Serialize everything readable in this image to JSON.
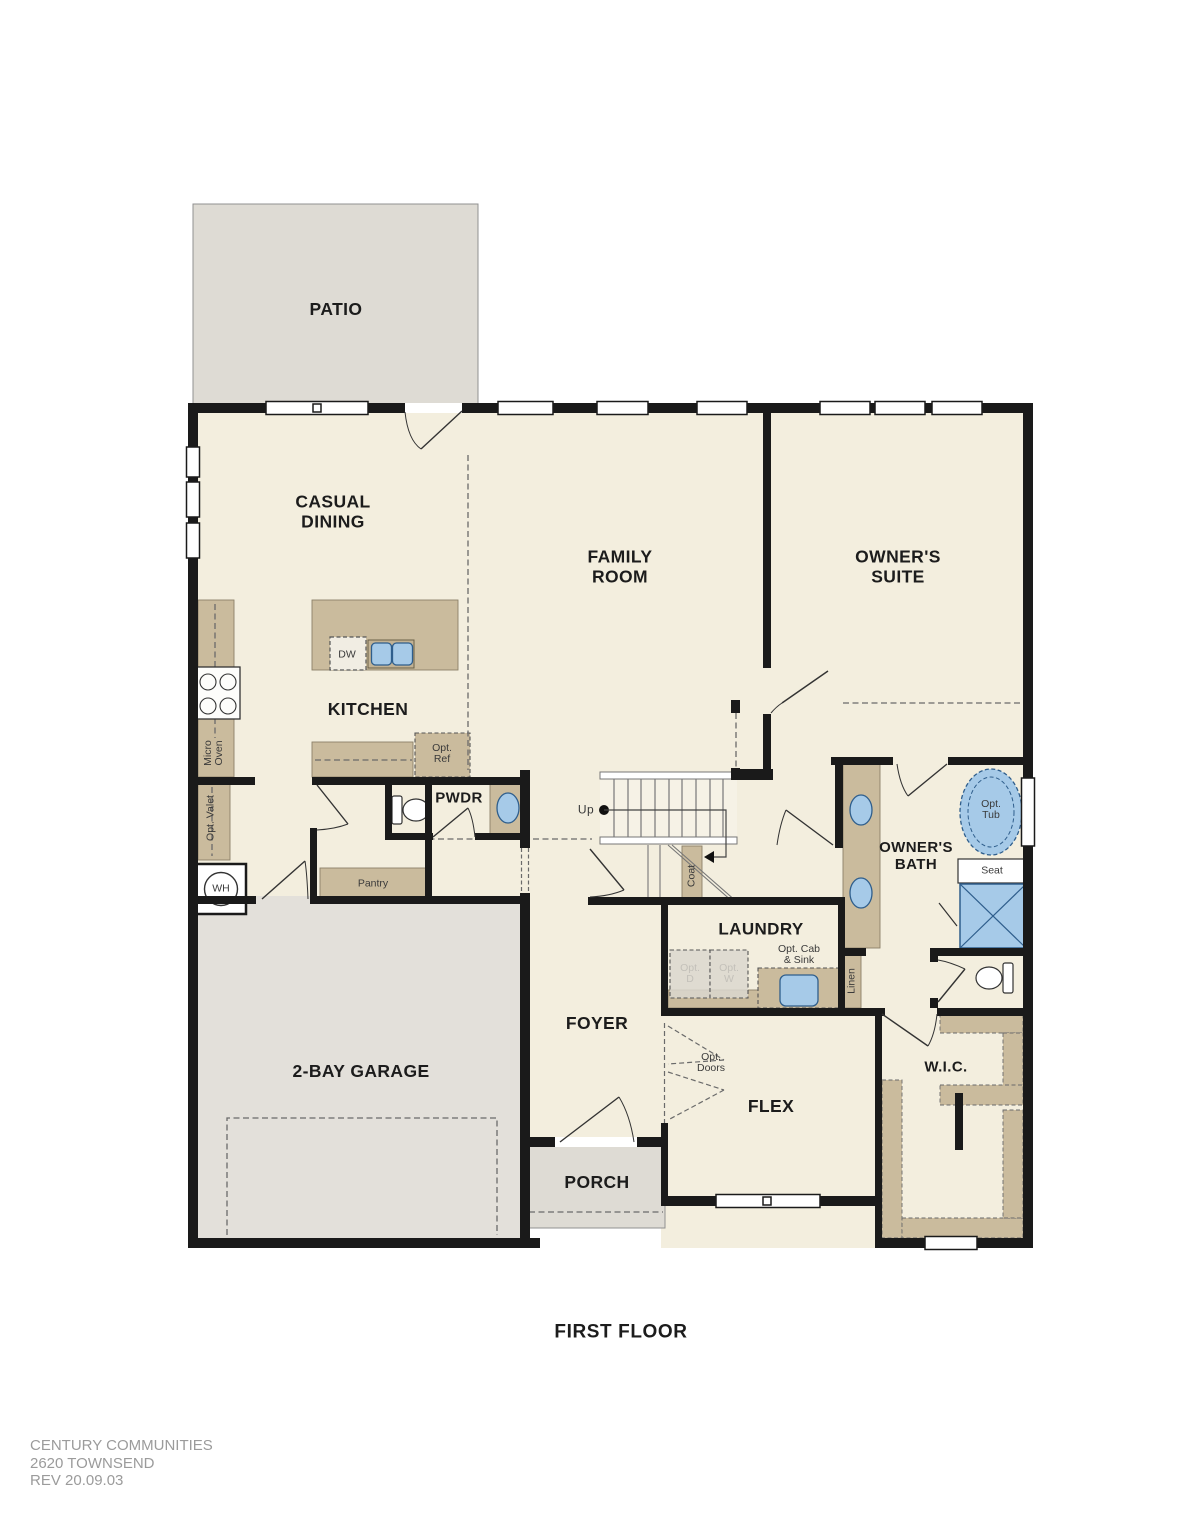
{
  "title": "FIRST FLOOR",
  "footer": {
    "company": "CENTURY COMMUNITIES",
    "plan_name": "2620 TOWNSEND",
    "revision": "REV 20.09.03"
  },
  "rooms": {
    "patio": "PATIO",
    "casual_dining": "CASUAL\nDINING",
    "family_room": "FAMILY\nROOM",
    "owners_suite": "OWNER'S\nSUITE",
    "kitchen": "KITCHEN",
    "pwdr": "PWDR",
    "garage": "2-BAY GARAGE",
    "foyer": "FOYER",
    "laundry": "LAUNDRY",
    "owners_bath": "OWNER'S\nBATH",
    "flex": "FLEX",
    "porch": "PORCH",
    "wic": "W.I.C."
  },
  "features": {
    "micro_oven": "Micro\nOven",
    "opt_valet": "Opt. Valet",
    "water_heater": "WH",
    "pantry": "Pantry",
    "dishwasher": "DW",
    "opt_ref": "Opt.\nRef",
    "up": "Up",
    "coat": "Coat",
    "opt_dryer": "Opt.\nD",
    "opt_washer": "Opt.\nW",
    "opt_cab_sink": "Opt. Cab\n& Sink",
    "linen": "Linen",
    "opt_tub": "Opt.\nTub",
    "seat": "Seat",
    "opt_doors": "Opt.\nDoors"
  },
  "colors": {
    "wall": "#1a1a1a",
    "room_fill": "#f3eede",
    "patio_porch_fill": "#dedbd4",
    "garage_fill": "#e3e0da",
    "cabinet_tan": "#cabb9d",
    "fixture_blue": "#a6cae8",
    "fixture_blue_border": "#2f5e8c",
    "footer_text": "#9b9b9b"
  }
}
